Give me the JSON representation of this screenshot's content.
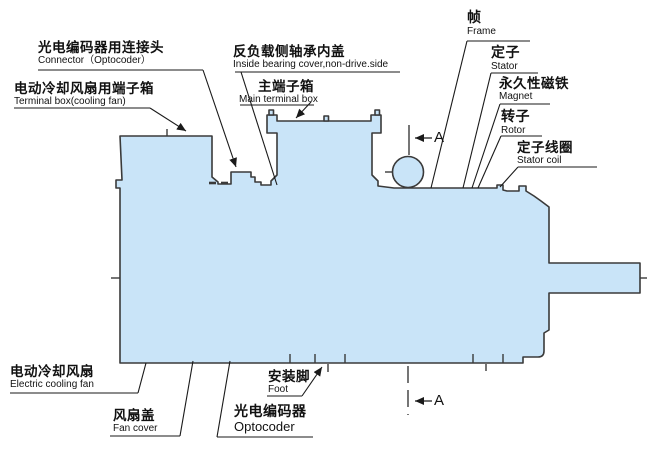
{
  "diagram": {
    "kind": "motor-cross-section",
    "description": "Servo motor outline drawing with bilingual part callouts"
  },
  "colors": {
    "body_fill": "#c9e4f8",
    "outline": "#3a3a3a",
    "leader": "#1a1a1a",
    "text": "#111111",
    "bg": "#ffffff"
  },
  "section_marker": {
    "letter": "A"
  },
  "labels": {
    "connector": {
      "zh": "光电编码器用连接头",
      "en": "Connector（Optocoder）"
    },
    "terminal_box_fan": {
      "zh": "电动冷却风扇用端子箱",
      "en": "Terminal box(cooling fan)"
    },
    "bearing_cover": {
      "zh": "反负载侧轴承内盖",
      "en": "Inside bearing cover,non-drive.side"
    },
    "main_terminal_box": {
      "zh": "主端子箱",
      "en": "Main terminal box"
    },
    "frame": {
      "zh": "帧",
      "en": "Frame"
    },
    "stator": {
      "zh": "定子",
      "en": "Stator"
    },
    "magnet": {
      "zh": "永久性磁铁",
      "en": "Magnet"
    },
    "rotor": {
      "zh": "转子",
      "en": "Rotor"
    },
    "stator_coil": {
      "zh": "定子线圈",
      "en": "Stator coil"
    },
    "electric_cooling_fan": {
      "zh": "电动冷却风扇",
      "en": "Electric cooling fan"
    },
    "fan_cover": {
      "zh": "风扇盖",
      "en": "Fan cover"
    },
    "optocoder": {
      "zh": "光电编码器",
      "en": "Optocoder"
    },
    "foot": {
      "zh": "安装脚",
      "en": "Foot"
    }
  }
}
